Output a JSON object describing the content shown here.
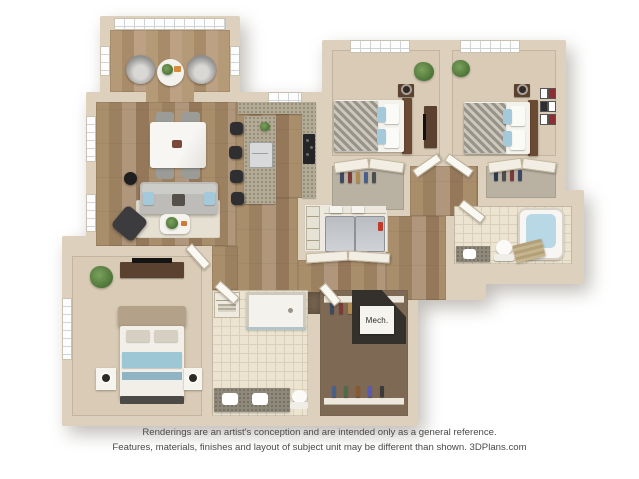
{
  "canvas": {
    "width": 639,
    "height": 479,
    "background": "#ffffff"
  },
  "floorplan": {
    "type": "3d-rendered-floor-plan",
    "labels": {
      "mech": "Mech."
    },
    "palette": {
      "wall": "#ddd1bd",
      "wood_floor": "#a98e6c",
      "carpet": "#d9cbb5",
      "bath_tile": "#ece4d1",
      "closet_floor": "#7e6a54",
      "granite_counter": "#b2aa94",
      "sofa_gray": "#bdbcb8",
      "accent_blue": "#a3c9da",
      "dark_furniture": "#3a3a3c",
      "plant_green": "#4e7539"
    },
    "rooms": [
      {
        "id": "sunroom",
        "furniture": [
          "two round lounge chairs",
          "round side table with plant",
          "wall of windows"
        ]
      },
      {
        "id": "living-dining-room",
        "furniture": [
          "marble dining table with four gray chairs",
          "gray sofa with blue pillows",
          "area rug",
          "coffee table with plant",
          "dark accent chair",
          "round side table",
          "two windows"
        ]
      },
      {
        "id": "kitchen",
        "furniture": [
          "granite island with sink",
          "four black bar stools",
          "L-shaped counter",
          "cooktop",
          "window"
        ]
      },
      {
        "id": "laundry-closet",
        "furniture": [
          "washer",
          "dryer",
          "wire shelf with baskets",
          "pantry shelves",
          "bifold doors"
        ]
      },
      {
        "id": "bedroom-2",
        "furniture": [
          "bed with chevron duvet and blue pillows",
          "nightstand",
          "media stand",
          "plant",
          "window",
          "sliding-door closet"
        ]
      },
      {
        "id": "bedroom-3",
        "furniture": [
          "bed with chevron duvet and blue pillows",
          "nightstand",
          "gallery wall frames",
          "plant",
          "window",
          "sliding-door closet"
        ]
      },
      {
        "id": "hall-bathroom",
        "furniture": [
          "bathtub",
          "toilet",
          "granite vanity",
          "tile floor"
        ]
      },
      {
        "id": "hallway",
        "furniture": [
          "wood flooring",
          "doors to bedrooms and bath"
        ]
      },
      {
        "id": "master-bedroom",
        "furniture": [
          "bed with upholstered headboard and blue blanket",
          "two nightstands with lamps",
          "dresser with tv",
          "plant",
          "window"
        ]
      },
      {
        "id": "master-bathroom",
        "furniture": [
          "walk-in shower",
          "double granite vanity",
          "toilet",
          "linen shelf",
          "tile floor"
        ]
      },
      {
        "id": "walk-in-closet",
        "furniture": [
          "clothes rails on two sides",
          "hanging clothes"
        ]
      },
      {
        "id": "mechanical-closet",
        "furniture": [
          "mechanical unit"
        ]
      }
    ]
  },
  "disclaimer": {
    "line1": "Renderings are an artist's conception and are intended only as a general reference.",
    "line2": "Features, materials, finishes and layout of subject unit may be different than shown. 3DPlans.com"
  }
}
